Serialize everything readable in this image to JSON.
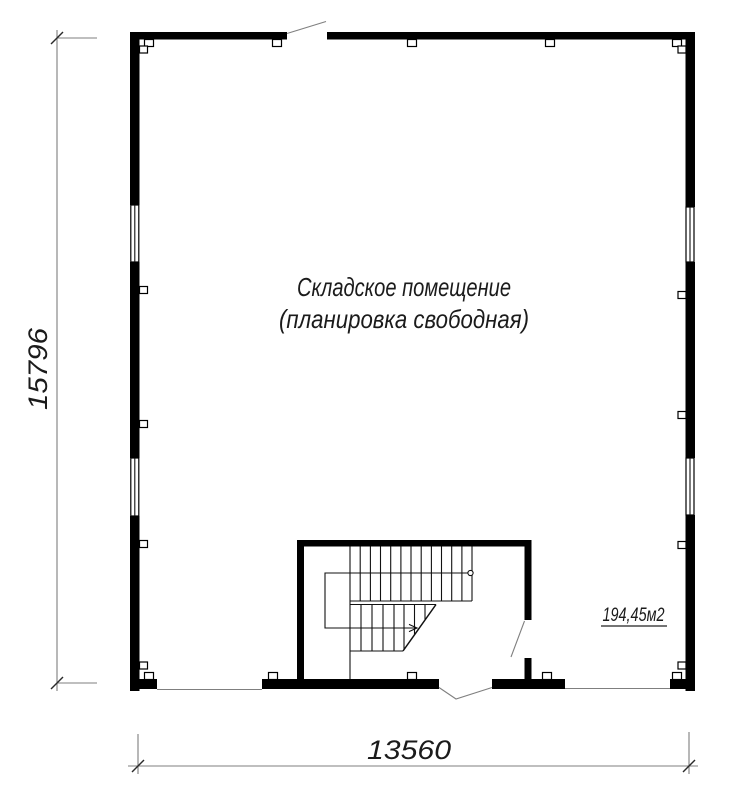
{
  "plan": {
    "room": {
      "label_line1": "Складское помещение",
      "label_line2": "(планировка свободная)",
      "area_label": "194,45м2"
    },
    "dimensions": {
      "height_mm": "15796",
      "width_mm": "13560"
    }
  },
  "colors": {
    "wall": "#000000",
    "dimension_line": "#7f7f7f",
    "text": "#1b1b1b",
    "background": "#ffffff"
  }
}
